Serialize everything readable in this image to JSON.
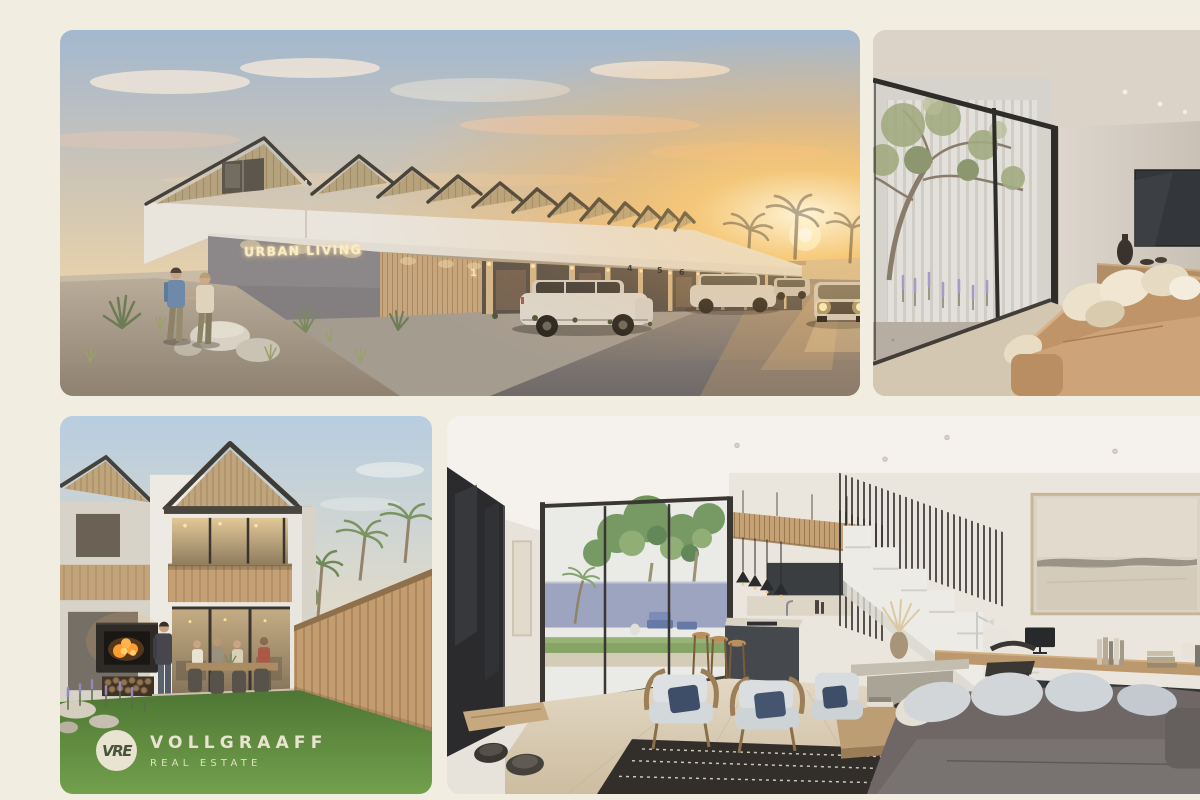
{
  "page": {
    "title": "Urban Living development photo collage",
    "background_color": "#f2ede1"
  },
  "brand": {
    "monogram": "VRE",
    "name": "VOLLGRAAFF",
    "tagline": "REAL ESTATE",
    "color": "#e9e4d1"
  },
  "signage": {
    "development_name": "URBAN LIVING",
    "unit_numbers": [
      "1",
      "4",
      "5",
      "6"
    ]
  },
  "photos": [
    {
      "id": "exterior-street-sunset",
      "description": "Row of modern gabled townhouses at sunset with illuminated Urban Living sign, parked SUVs and a couple walking among desert landscaping"
    },
    {
      "id": "living-room-glass-wall",
      "description": "Living room with floor-to-ceiling glass wall onto a planted courtyard, wall-mounted TV, timber console and tan sofa with cream cushions"
    },
    {
      "id": "backyard-dining",
      "description": "Back garden with green lawn, outdoor fireplace with stacked firewood, timber privacy fence and friends dining on the patio of a double-storey gabled home"
    },
    {
      "id": "open-plan-interior",
      "description": "Open-plan living space with slatted kitchen canopy, dark island, sculptural white staircase, built-in timber desk, artwork and lounge opening to a palm courtyard"
    }
  ],
  "palette": {
    "canvas_cream": "#f2ede1",
    "sky_blue": "#a3b8cf",
    "sunset_gold": "#f6b85e",
    "wood_tan": "#c2a075",
    "charcoal": "#3a3d40",
    "lawn_green": "#5f8c3e",
    "logo_cream": "#e9e4d1"
  }
}
